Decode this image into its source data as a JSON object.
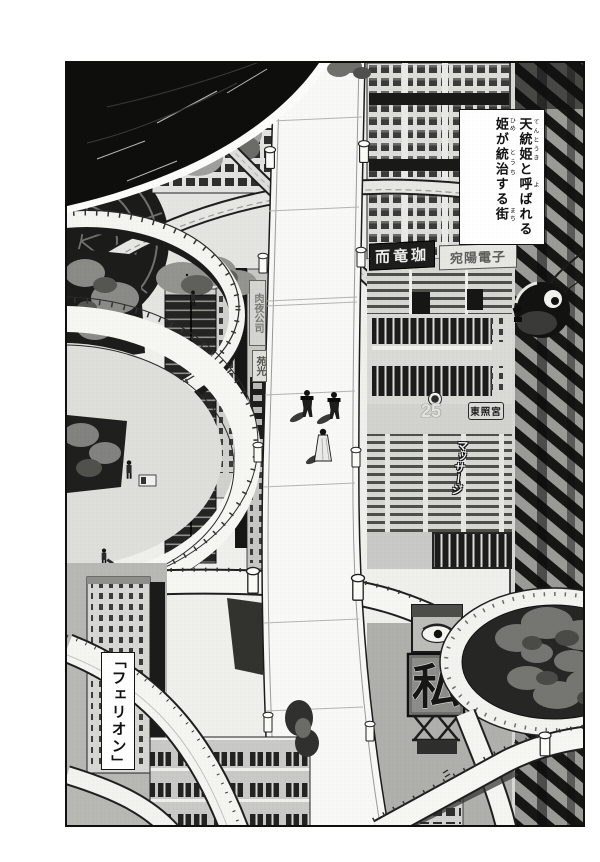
{
  "panel": {
    "narration": {
      "full_text": "天統姫と呼ばれる姫が統治する街",
      "lines": [
        {
          "segments": [
            {
              "text": "天統姫",
              "ruby": "てんとうき"
            },
            {
              "text": "と"
            },
            {
              "text": "呼",
              "ruby": "よ"
            },
            {
              "text": "ばれる"
            }
          ]
        },
        {
          "segments": [
            {
              "text": "姫",
              "ruby": "ひめ"
            },
            {
              "text": "が"
            },
            {
              "text": "統治",
              "ruby": "とうち"
            },
            {
              "text": "する"
            },
            {
              "text": "街",
              "ruby": "まち"
            }
          ]
        }
      ]
    },
    "caption": {
      "text": "「フェリオン」"
    },
    "signs": {
      "dragon_sign": "而竜珈",
      "electronics_sign": "宛陽電子",
      "company_sign_vertical": "肉夜公司",
      "enko_sign_vertical": "苑光",
      "building_number": "25",
      "toshogu_sign": "東照宮",
      "massage_sign_vertical": "マッサージ",
      "billboard_kanji": "私"
    },
    "colors": {
      "ink": "#141412",
      "paper": "#ffffff",
      "tone_light": "#e9e9e6",
      "tone_mid": "#b9b9b6",
      "tone_dark": "#55555",
      "black_fill": "#0e0e0c"
    }
  }
}
